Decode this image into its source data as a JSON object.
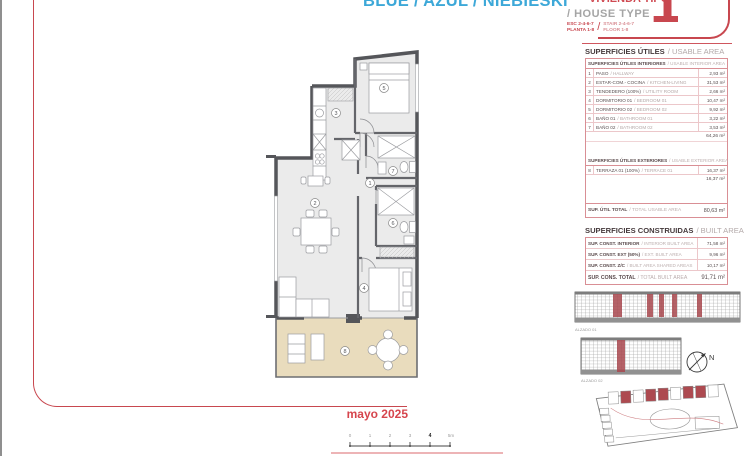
{
  "header": {
    "title_blue": "BLUE / AZUL / NIEBIESKI",
    "title_red": "VIVIENDA TIPO",
    "subtitle": "/ HOUSE TYPE",
    "esc_es_1": "ESC 2-4-6-7",
    "esc_es_2": "PLANTA 1-8",
    "esc_en_1": "STAIR 2-4-6-7",
    "esc_en_2": "FLOOR 1-8",
    "type_number": "1"
  },
  "usable": {
    "heading_es": "SUPERFICIES ÚTILES",
    "heading_en": "/ USABLE AREA",
    "interior_header_es": "SUPERFICIES ÚTILES INTERIORES",
    "interior_header_en": "/ USABLE INTERIOR AREA",
    "interior_rows": [
      {
        "n": "1",
        "es": "PASO",
        "en": "/ HALLWAY",
        "val": "2,93 m²"
      },
      {
        "n": "2",
        "es": "ESTAR-COM.- COCINA",
        "en": "/ KITCHEN-LIVING",
        "val": "31,53 m²"
      },
      {
        "n": "3",
        "es": "TENDEDERO (100%)",
        "en": "/ UTILITY ROOM",
        "val": "2,66 m²"
      },
      {
        "n": "4",
        "es": "DORMITORIO 01",
        "en": "/ BEDROOM 01",
        "val": "10,47 m²"
      },
      {
        "n": "5",
        "es": "DORMITORIO 02",
        "en": "/ BEDROOM 02",
        "val": "9,92 m²"
      },
      {
        "n": "6",
        "es": "BAÑO 01",
        "en": "/ BATHROOM 01",
        "val": "3,22 m²"
      },
      {
        "n": "7",
        "es": "BAÑO 02",
        "en": "/ BATHROOM 02",
        "val": "3,53 m²"
      }
    ],
    "interior_total": "64,26 m²",
    "exterior_header_es": "SUPERFICIES ÚTILES EXTERIORES",
    "exterior_header_en": "/ USABLE EXTERIOR AREA",
    "exterior_rows": [
      {
        "n": "8",
        "es": "TERRAZA 01 (100%)",
        "en": "/ TERRACE 01",
        "val": "16,37 m²"
      }
    ],
    "exterior_total": "16,37 m²",
    "total_es": "SUP. ÚTIL TOTAL",
    "total_en": "/ TOTAL USABLE AREA",
    "total_val": "80,63 m²"
  },
  "built": {
    "heading_es": "SUPERFICIES CONSTRUIDAS",
    "heading_en": "/ BUILT AREA",
    "rows": [
      {
        "es": "SUP. CONST. INTERIOR",
        "en": "/ INTERIOR BUILT AREA",
        "val": "71,58 m²"
      },
      {
        "es": "SUP. CONST. EXT (50%)",
        "en": "/ EXT. BUILT AREA",
        "val": "9,96 m²"
      },
      {
        "es": "SUP. CONST. Z/C",
        "en": "/ BUILT AREA SHARED AREAS",
        "val": "10,17 m²"
      }
    ],
    "total_es": "SUP. CONS. TOTAL",
    "total_en": "/ TOTAL BUILT AREA",
    "total_val": "91,71 m²"
  },
  "elevations": {
    "label_1": "ALZADO 01",
    "label_2": "ALZADO 02"
  },
  "compass": {
    "north": "N"
  },
  "plan": {
    "labels": [
      "1",
      "2",
      "3",
      "4",
      "5",
      "6",
      "7",
      "8"
    ]
  },
  "footer": {
    "date": "mayo 2025"
  },
  "scalebar": {
    "ticks": [
      "0",
      "1",
      "2",
      "3",
      "4",
      "5m"
    ]
  },
  "colors": {
    "accent_red": "#c8474f",
    "accent_blue": "#3da8d8"
  }
}
